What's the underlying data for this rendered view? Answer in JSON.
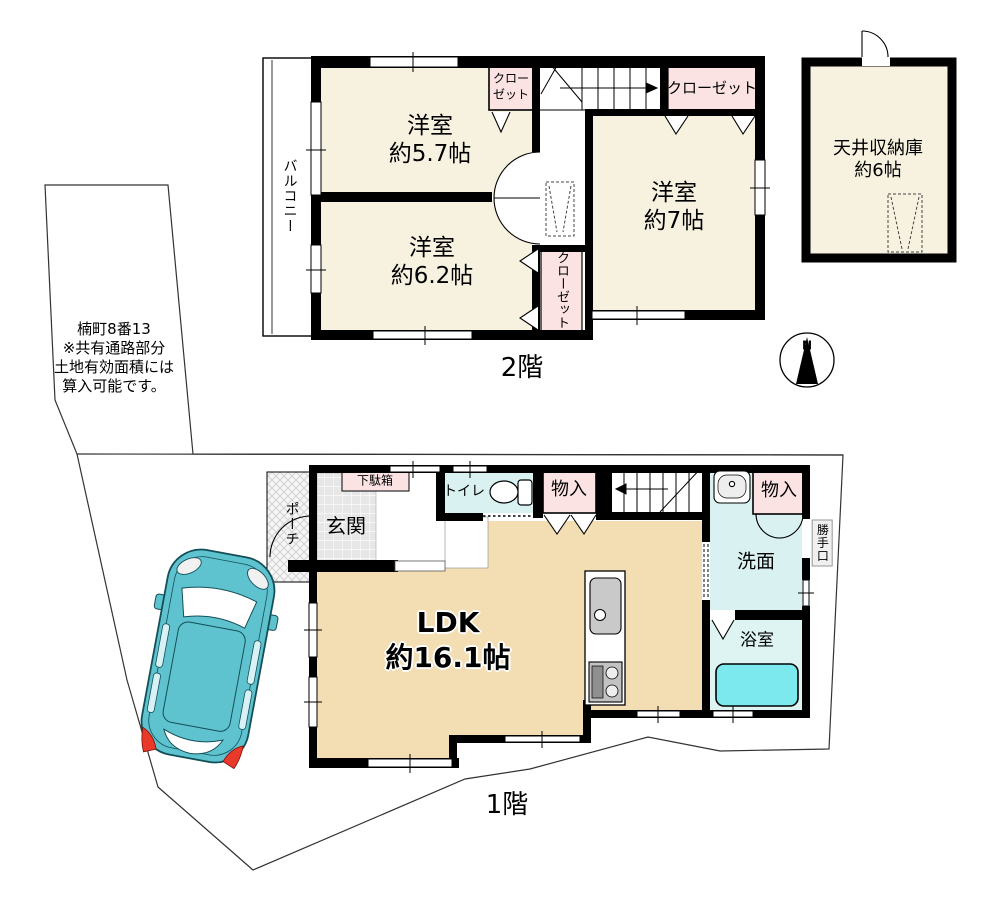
{
  "floor2": {
    "balcony_label": "バルコニー",
    "room_5_7_label": "洋室\n約5.7帖",
    "room_6_2_label": "洋室\n約6.2帖",
    "room_7_label": "洋室\n約7帖",
    "closet_5_7_label": "クロー\nゼット",
    "closet_6_2_label": "クローゼット",
    "closet_7_label": "クローゼット",
    "attic_label": "天井収納庫\n約6帖",
    "floor_label": "2階"
  },
  "floor1": {
    "porch_label": "ポーチ",
    "shoe_cabinet_label": "下駄箱",
    "entrance_label": "玄関",
    "toilet_label": "トイレ",
    "storage_left_label": "物入",
    "storage_right_label": "物入",
    "washroom_label": "洗面",
    "back_door_label": "勝手口",
    "bathroom_label": "浴室",
    "ldk_label": "LDK\n約16.1帖",
    "floor_label": "1階"
  },
  "site": {
    "note": "楠町8番13\n※共有通路部分\n土地有効面積には\n算入可能です。"
  },
  "compass": {
    "north_label": "N"
  },
  "colors": {
    "room_cream": "#f7f2e0",
    "ldk_beige": "#f3deb3",
    "closet_pink": "#fbe3e3",
    "wet_cyan": "#d9f2f1",
    "bathtub_cyan": "#7ce9ef",
    "car_teal": "#5ec3ce",
    "wall_black": "#000000"
  }
}
